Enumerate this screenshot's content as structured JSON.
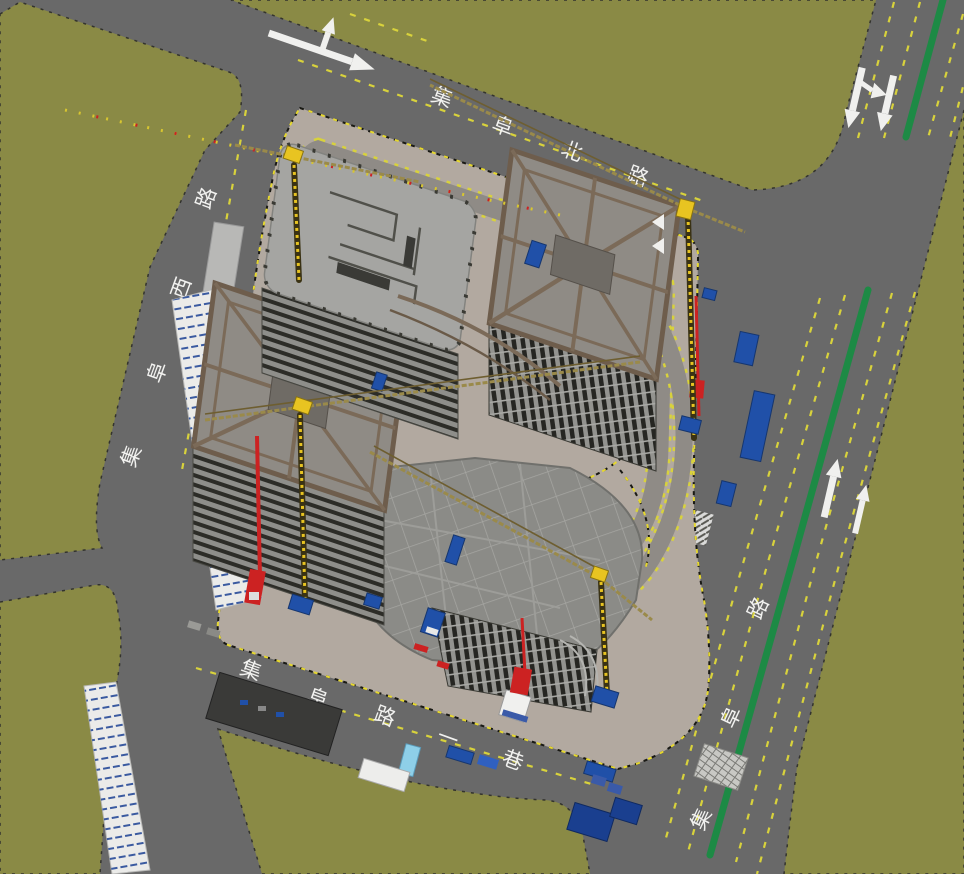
{
  "viewport": {
    "type": "3d-site-model-view"
  },
  "roads": {
    "north": {
      "name": "集阜北路",
      "chars": [
        "集",
        "阜",
        "北",
        "路"
      ]
    },
    "west": {
      "name": "集阜西路",
      "chars": [
        "集",
        "阜",
        "西",
        "路"
      ]
    },
    "east": {
      "name": "集阜路",
      "chars": [
        "集",
        "阜",
        "路"
      ]
    },
    "south": {
      "name": "集阜路一巷",
      "chars": [
        "集",
        "阜",
        "路",
        "一",
        "巷"
      ]
    }
  },
  "road_markings": {
    "north_road_arrow": "straight-and-left-turn",
    "east_road_top_arrows": [
      "straight-and-right-turn",
      "straight"
    ],
    "east_road_bottom_arrows": [
      "straight",
      "straight"
    ],
    "median": "green-divider",
    "lane_lines": "yellow-dashed"
  },
  "site": {
    "buildings": [
      "northwest-tower",
      "northeast-tower",
      "southwest-tower",
      "south-podium"
    ],
    "tower_crane_count": 4,
    "equipment": [
      "tower-crane",
      "concrete-placing-boom",
      "material-hoist",
      "covered-walkway",
      "site-fence",
      "flatbed-truck",
      "dumpster",
      "storage-tarp",
      "rebar-rack",
      "site-shed"
    ]
  },
  "colors": {
    "ground_green": "#8a8a45",
    "asphalt": "#696969",
    "site_ground": "#b2a9a0",
    "internal_road": "#8f8b86",
    "median_green": "#1d8a45",
    "lane_yellow": "#d8d23c",
    "marking_white": "#f0f0ee",
    "crane_yellow": "#e8c421",
    "truss_brown": "#7b6a58",
    "truck_blue": "#2050a8",
    "tarp_blue": "#1a3f8f",
    "alert_red": "#cc2222",
    "walkway_white": "#ebebe9"
  }
}
